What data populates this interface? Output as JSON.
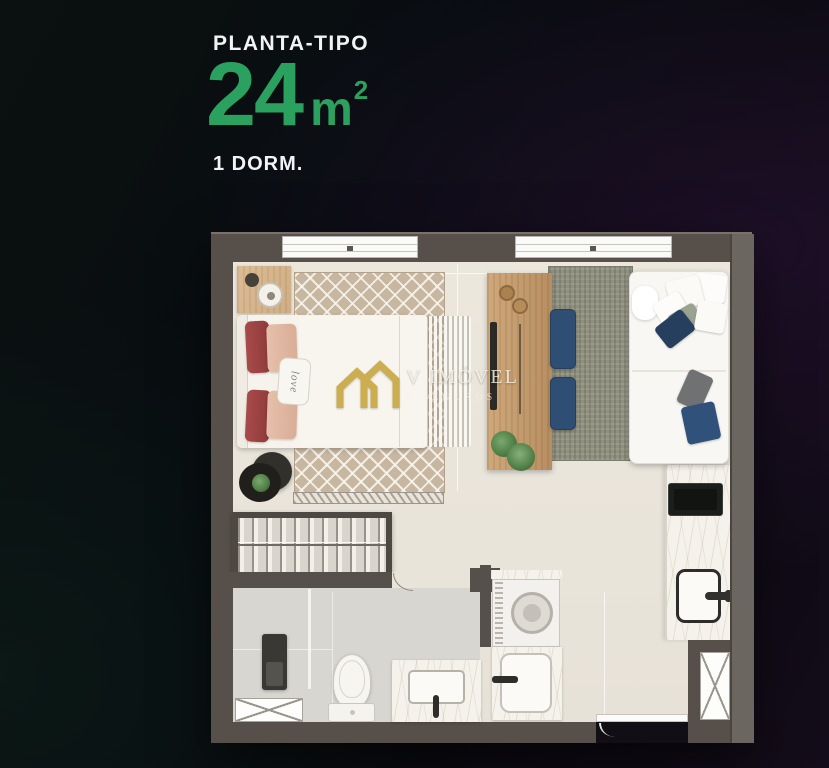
{
  "header": {
    "kicker": "PLANTA-TIPO",
    "area_number": "24",
    "area_unit": "m",
    "area_exponent": "2",
    "dormitories": "1 DORM."
  },
  "watermark": {
    "brand": "V IMÓVEL",
    "tagline": "E SEGUROS",
    "icon": "double-house-logo-icon"
  },
  "bedroom": {
    "pillow_text": "love"
  },
  "colors": {
    "accent_green": "#2aa15e",
    "heading_text": "#f3f3f3",
    "watermark_gold": "#c9a742",
    "wall": "#57504a",
    "wall_right": "#6c6660",
    "floor_beige": "#ebe6dc",
    "floor_bath_gray": "#d8d6d1",
    "wood": "#c9a477",
    "rug_living": "#8e8f7e",
    "rug_bedroom": "#c7b7a1",
    "pouf_navy": "#2f4e74",
    "bed_maroon": "#9a4343",
    "bed_blush": "#dfb6a1",
    "background_dark": "#0a0d11"
  }
}
